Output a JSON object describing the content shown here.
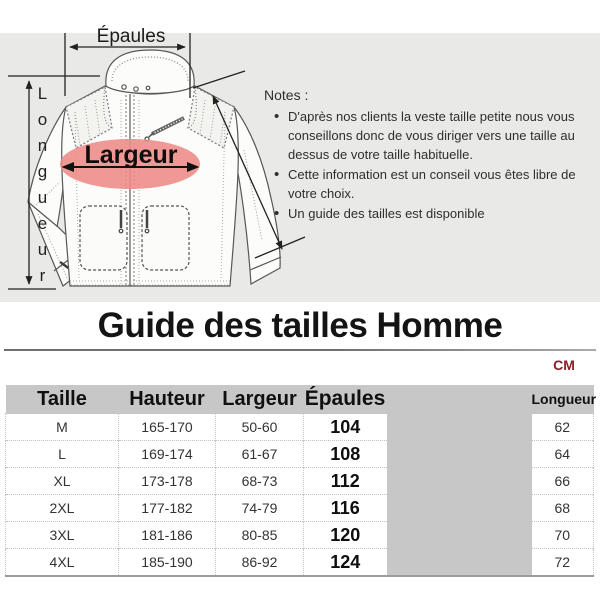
{
  "diagram": {
    "shoulder_label": "Épaules",
    "length_label": "Longueur",
    "width_label": "Largeur"
  },
  "notes": {
    "heading": "Notes :",
    "items": [
      "D'après nos clients  la veste taille petite nous vous conseillons donc de vous diriger vers une taille au dessus de votre taille habituelle.",
      "Cette information est un conseil vous êtes libre de votre choix.",
      "Un guide des tailles est disponible"
    ]
  },
  "section_title": "Guide des tailles Homme",
  "unit_label": "CM",
  "size_table": {
    "headers": {
      "taille": "Taille",
      "hauteur": "Hauteur",
      "largeur": "Largeur",
      "epaules": "Épaules",
      "longueur": "Longueur"
    },
    "rows": [
      {
        "taille": "M",
        "hauteur": "165-170",
        "largeur": "50-60",
        "epaules": "104",
        "longueur": "62"
      },
      {
        "taille": "L",
        "hauteur": "169-174",
        "largeur": "61-67",
        "epaules": "108",
        "longueur": "64"
      },
      {
        "taille": "XL",
        "hauteur": "173-178",
        "largeur": "68-73",
        "epaules": "112",
        "longueur": "66"
      },
      {
        "taille": "2XL",
        "hauteur": "177-182",
        "largeur": "74-79",
        "epaules": "116",
        "longueur": "68"
      },
      {
        "taille": "3XL",
        "hauteur": "181-186",
        "largeur": "80-85",
        "epaules": "120",
        "longueur": "70"
      },
      {
        "taille": "4XL",
        "hauteur": "185-190",
        "largeur": "86-92",
        "epaules": "124",
        "longueur": "72"
      }
    ]
  },
  "colors": {
    "highlight_ellipse": "#ed8a87",
    "unit_label_color": "#8b2025",
    "table_header_bg": "#c7c7c7",
    "top_section_bg": "#e9e9e7"
  }
}
